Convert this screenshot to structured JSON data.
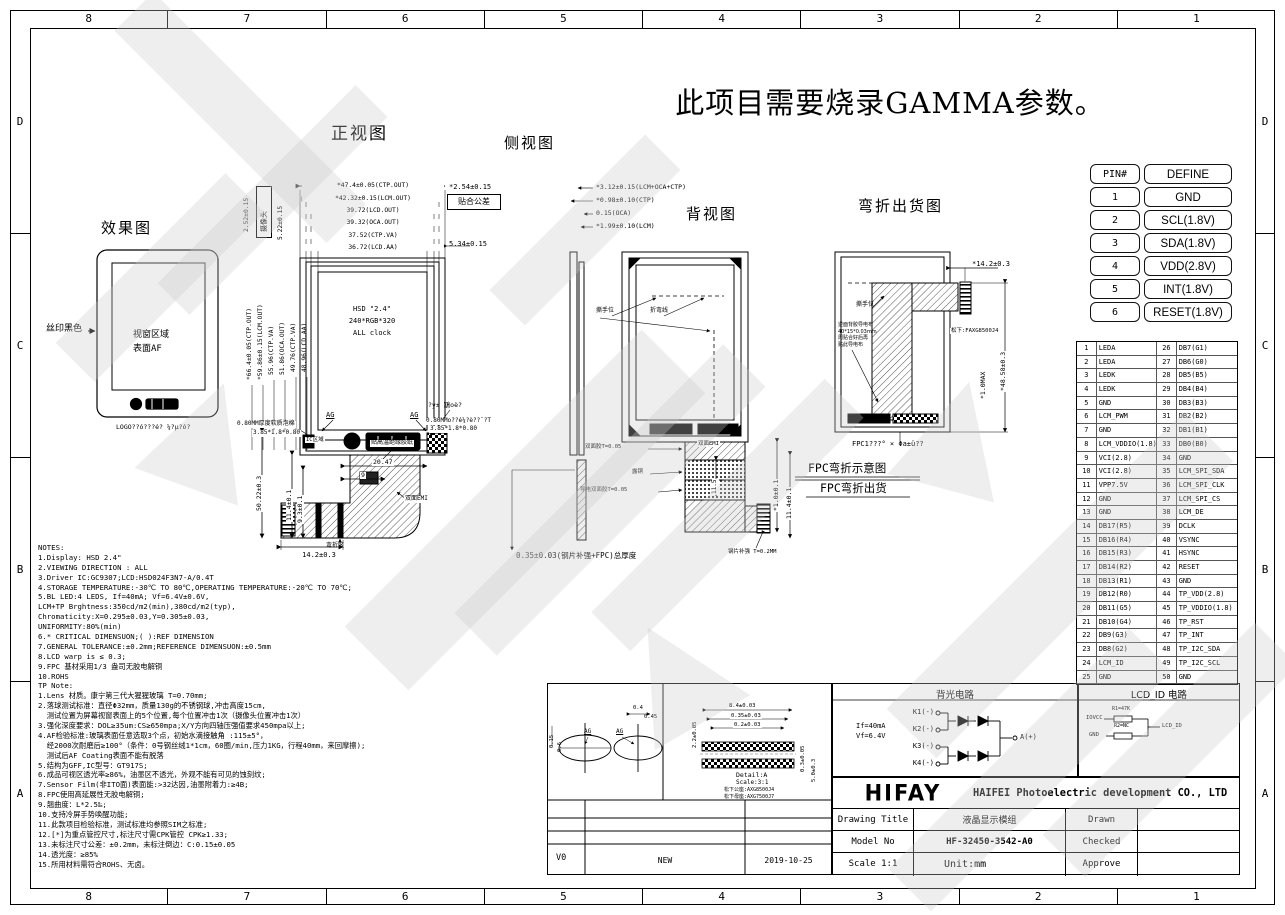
{
  "banner": "此项目需要烧录GAMMA参数。",
  "border": {
    "cols": [
      "8",
      "7",
      "6",
      "5",
      "4",
      "3",
      "2",
      "1"
    ],
    "rows": [
      "D",
      "C",
      "B",
      "A"
    ]
  },
  "pin_define": {
    "h1": "PIN#",
    "h2": "DEFINE",
    "rows": [
      [
        "1",
        "GND"
      ],
      [
        "2",
        "SCL(1.8V)"
      ],
      [
        "3",
        "SDA(1.8V)"
      ],
      [
        "4",
        "VDD(2.8V)"
      ],
      [
        "5",
        "INT(1.8V)"
      ],
      [
        "6",
        "RESET(1.8V)"
      ]
    ]
  },
  "pin50": {
    "rows": [
      [
        "1",
        "LEDA",
        "26",
        "DB7(G1)"
      ],
      [
        "2",
        "LEDA",
        "27",
        "DB6(G0)"
      ],
      [
        "3",
        "LEDK",
        "28",
        "DB5(B5)"
      ],
      [
        "4",
        "LEDK",
        "29",
        "DB4(B4)"
      ],
      [
        "5",
        "GND",
        "30",
        "DB3(B3)"
      ],
      [
        "6",
        "LCM_PWM",
        "31",
        "DB2(B2)"
      ],
      [
        "7",
        "GND",
        "32",
        "DB1(B1)"
      ],
      [
        "8",
        "LCM_VDDIO(1.8)",
        "33",
        "DB0(B0)"
      ],
      [
        "9",
        "VCI(2.8)",
        "34",
        "GND"
      ],
      [
        "10",
        "VCI(2.8)",
        "35",
        "LCM_SPI_SDA"
      ],
      [
        "11",
        "VPP7.5V",
        "36",
        "LCM_SPI_CLK"
      ],
      [
        "12",
        "GND",
        "37",
        "LCM_SPI_CS"
      ],
      [
        "13",
        "GND",
        "38",
        "LCM_DE"
      ],
      [
        "14",
        "DB17(R5)",
        "39",
        "DCLK"
      ],
      [
        "15",
        "DB16(R4)",
        "40",
        "VSYNC"
      ],
      [
        "16",
        "DB15(R3)",
        "41",
        "HSYNC"
      ],
      [
        "17",
        "DB14(R2)",
        "42",
        "RESET"
      ],
      [
        "18",
        "DB13(R1)",
        "43",
        "GND"
      ],
      [
        "19",
        "DB12(R0)",
        "44",
        "TP_VDD(2.8)"
      ],
      [
        "20",
        "DB11(G5)",
        "45",
        "TP_VDDIO(1.8)"
      ],
      [
        "21",
        "DB10(G4)",
        "46",
        "TP_RST"
      ],
      [
        "22",
        "DB9(G3)",
        "47",
        "TP_INT"
      ],
      [
        "23",
        "DB8(G2)",
        "48",
        "TP_I2C_SDA"
      ],
      [
        "24",
        "LCM_ID",
        "49",
        "TP_I2C_SCL"
      ],
      [
        "25",
        "GND",
        "50",
        "GND"
      ]
    ]
  },
  "effect": {
    "title": "效果图",
    "silk": "丝印黑色",
    "win1": "视窗区域",
    "win2": "表面AF",
    "caption": "LOGO??ó???é? ¼?µ?ó?"
  },
  "front": {
    "title": "正视图",
    "dims_top": [
      "*47.4±0.05(CTP.OUT)",
      "*42.32±0.15(LCM.OUT)",
      "39.72(LCD.OUT)",
      "39.32(OCA.OUT)",
      "37.52(CTP.VA)",
      "36.72(LCD.AA)"
    ],
    "bond": "*2.54±0.15",
    "bond_box": "贴合公差",
    "d534": "5.34±0.15",
    "d252": "2.52±0.15",
    "cam": "摄像头",
    "d522": "5.22±0.15",
    "dims_left": [
      "*66.4±0.05(CTP.OUT)",
      "*59.86±0.15(LCM.OUT)",
      "55.96(CTP.VA)",
      "51.86(OCA.OUT)",
      "49.76(CTP.VA)",
      "48.96(LCD.AA)"
    ],
    "c1": "HSD \"2.4\"",
    "c2": "240*RGB*320",
    "c3": "ALL clock",
    "ag": "AG",
    "foam1": "0.80MM厚度软质泡棉",
    "foam2": "3.85*1.8*0.80",
    "ic": "IC区域",
    "foam3": "0.80MMo??é¼?è??ˉ?T",
    "foam4": "3.85*1.8*0.80",
    "myst": "?y± 鶷oè?",
    "tape": "贴高温绝缘胶纸",
    "emi": "双面EMI",
    "bendzone": "弯折区",
    "d2047": "20.47",
    "d9": "9",
    "d5022": "50.22±0.3",
    "d114": "11.4±0.1",
    "d93": "9.3±0.1",
    "d142": "14.2±0.3"
  },
  "side": {
    "title": "侧视图",
    "dims": [
      "*3.12±0.15(LCM+OCA+CTP)",
      "*0.98±0.10(CTP)",
      "0.15(OCA)",
      "*1.99±0.10(LCM)"
    ],
    "total": "0.35±0.03(钢片补强+FPC)总厚度"
  },
  "back": {
    "title": "背视图",
    "tear": "撕手位",
    "fold": "折弯线",
    "tape": "双面胶T=0.05",
    "copper": "露铜",
    "cond": "导电双面胶T=0.05",
    "emi": "双面EMI",
    "steel": "钢片补强 T=0.2MM",
    "d115": "11.5",
    "d114": "11.4±0.1",
    "d10": "*1.0±0.1"
  },
  "bend": {
    "title": "弯折出货图",
    "d142": "*14.2±0.3",
    "d4858": "*48.58±0.3",
    "d10max": "*1.0MAX",
    "conn": "松下:FAXG8500J4",
    "tear": "撕手位",
    "note_lines": [
      "逆面背胶导电布",
      "40*15*0.03mm",
      "周贴合好后再",
      "贴此导电布"
    ],
    "caption": "FPC1???° × Φa±ü??",
    "sub1": "FPC弯折示意图",
    "sub2": "FPC弯折出货"
  },
  "notes": [
    "NOTES:",
    "1.Display: HSD 2.4\"",
    "2.VIEWING DIRECTION : ALL",
    "3.Driver IC:GC9307;LCD:HSD024F3N7-A/0.4T",
    "4.STORAGE TEMPERATURE:-30℃ TO 80℃,OPERATING TEMPERATURE:-20℃ TO 70℃;",
    "5.BL LED:4 LEDS, If=40mA; Vf=6.4V±0.6V,",
    "LCM+TP Brghtness:350cd/m2(min),380cd/m2(typ),",
    "Chromaticity:X=0.295±0.03,Y=0.305±0.03,",
    "UNIFORMITY:80%(min)",
    "6.* CRITICAL DIMENSUON;( ):REF DIMENSION",
    "7.GENERAL TOLERANCE:±0.2mm;REFERENCE DIMENSUON:±0.5mm",
    "8.LCD warp is ≤ 0.3;",
    "9.FPC 基材采用1/3 盎司无胶电解铜",
    "10.ROHS",
    "TP Note:",
    "1.Lens 材质。康宁第三代大猩猩玻璃 T=0.70mm;",
    "2.落球测试标准：直径Φ32mm，质量130g的不锈钢球,冲击高度15cm,",
    "  测试位置为屏幕视窗表面上的5个位置,每个位置冲击1次（摄像头位置冲击1次）",
    "3.强化深度要求：DOL≥35um:CS≥650mpa;X/Y方向四轴压强值要求450mpa以上;",
    "4.AF检验标准:玻璃表面任意选取3个点，初始水滴接触角 :115±5°，",
    "  经2000次耐磨后≥100°（条件：0号钢丝绒1*1cm，60圈/min,压力1KG，行程40mm，来回摩擦);",
    "  测试后AF Coating表面不能有脱落",
    "5.结构为GFF,IC型号：GT917S;",
    "6.成品可视区透光率≥86%，油墨区不透光，外观不能有可见的蚀刻纹;",
    "7.Sensor Film(非ITO面)表面能:>32达因,油墨附着力:≥4B;",
    "8.FPC使用高延展性无胶电解铜;",
    "9.翘曲度：L*2.5‰;",
    "10.支持冷屏手势唤醒功能;",
    "11.此款项目检验标准，测试标准均参照SIM之标准;",
    "12.[*]为重点管控尺寸,标注尺寸需CPK管控 CPK≥1.33;",
    "13.未标注尺寸公差：±0.2mm，未标注倒边：C:0.15±0.05",
    "14.透光度：≥85%",
    "15.所用材料需符合ROHS、无卤。"
  ],
  "detail": {
    "d015": "0.15",
    "d06": "0.6",
    "ag": "AG",
    "d04": "0.4",
    "d045": "0.45",
    "d84": "8.4±0.03",
    "d035": "0.35±0.03",
    "d02": "0.2±0.03",
    "d22": "2.2±0.05",
    "d03": "0.3±0.05",
    "d50": "5.0±0.3",
    "name": "Detail:A",
    "scale": "Scale:3:1",
    "pn1": "松下公座:AXG8500J4",
    "pn2": "松下母座:AXG7500J7"
  },
  "revision": {
    "ver": "V0",
    "desc": "NEW",
    "date": "2019-10-25"
  },
  "backlight": {
    "title": "背光电路",
    "k": [
      "K1(-)",
      "K2(-)",
      "K3(-)",
      "K4(-)"
    ],
    "anode": "A(+)",
    "cur": "If=40mA",
    "volt": "Vf=6.4V"
  },
  "lcd_id": {
    "title": "LCD_ID 电路",
    "iovcc": "IOVCC",
    "r1": "R1=47K",
    "gnd": "GND",
    "r2": "R2=NC",
    "out": "LCD_ID"
  },
  "titleblock": {
    "logo": "HIFAY",
    "company": "HAIFEI Photoelectric development CO., LTD",
    "dt_label": "Drawing Title",
    "dt_value": "液晶显示模组",
    "drawn": "Drawn",
    "mn_label": "Model No",
    "mn_value": "HF-32450-3542-A0",
    "checked": "Checked",
    "scale_label": "Scale 1:1",
    "unit": "Unit:mm",
    "approve": "Approve"
  }
}
